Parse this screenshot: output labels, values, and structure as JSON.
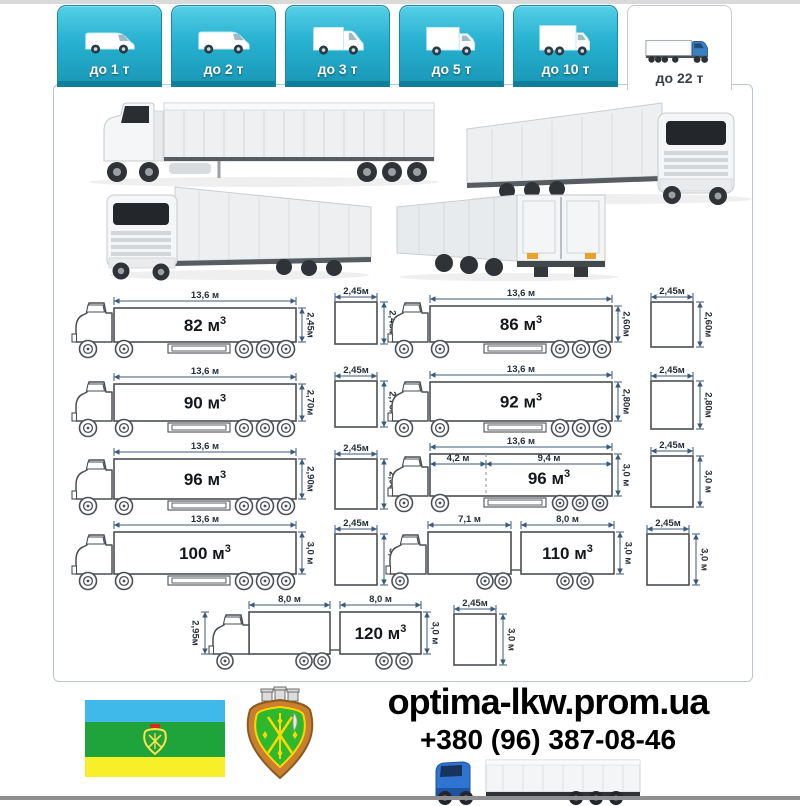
{
  "tabs": [
    {
      "label": "до 1 т",
      "icon": "van-icon",
      "active": false
    },
    {
      "label": "до 2 т",
      "icon": "van-icon",
      "active": false
    },
    {
      "label": "до 3 т",
      "icon": "tall-van-icon",
      "active": false
    },
    {
      "label": "до 5 т",
      "icon": "box-truck-icon",
      "active": false
    },
    {
      "label": "до 10 т",
      "icon": "big-box-truck-icon",
      "active": false
    },
    {
      "label": "до 22 т",
      "icon": "semi-truck-icon",
      "active": true
    }
  ],
  "diagrams": [
    {
      "volume": "82 м³",
      "length": "13,6 м",
      "height": "2,45м",
      "square_w": "2,45м",
      "square_h": "2,45м"
    },
    {
      "volume": "86 м³",
      "length": "13,6 м",
      "height": "2,60м",
      "square_w": "2,45м",
      "square_h": "2,60м"
    },
    {
      "volume": "90 м³",
      "length": "13,6 м",
      "height": "2,70м",
      "square_w": "2,45м",
      "square_h": "2,70м"
    },
    {
      "volume": "92 м³",
      "length": "13,6 м",
      "height": "2,80м",
      "square_w": "2,45м",
      "square_h": "2,80м"
    },
    {
      "volume": "96 м³",
      "length": "13,6 м",
      "height": "2,90м",
      "square_w": "2,45м",
      "square_h": "2,90м"
    },
    {
      "volume": "96 м³",
      "length": "13,6 м",
      "front_length": "4,2 м",
      "rear_length": "9,4 м",
      "height": "3,0 м",
      "square_w": "2,45м",
      "square_h": "3,0 м"
    },
    {
      "volume": "100 м³",
      "length": "13,6 м",
      "height": "3,0 м",
      "square_w": "2,45м",
      "square_h": "3,0 м"
    },
    {
      "volume": "110 м³",
      "box1_length": "7,1 м",
      "box2_length": "8,0 м",
      "height": "3,0 м",
      "square_w": "2,45м",
      "square_h": "3,0 м"
    },
    {
      "volume": "120 м³",
      "box1_length": "8,0 м",
      "box2_length": "8,0 м",
      "left_height": "2,95м",
      "height": "3,0 м",
      "square_w": "2,45м",
      "square_h": "3,0 м"
    }
  ],
  "footer": {
    "site": "optima-lkw.prom.ua",
    "phone": "+380 (96) 387-08-46"
  },
  "colors": {
    "tab_cyan": "#29b2d2",
    "tab_cyan_dark": "#0f7e99",
    "panel_border": "#bac7cf",
    "dimension_line": "#3b5a7a",
    "dimension_text": "#242e38",
    "flag_blue": "#3fb9e9",
    "flag_green": "#1fa43c",
    "flag_yellow": "#f7ef28",
    "cab_blue": "#2f74d0"
  }
}
